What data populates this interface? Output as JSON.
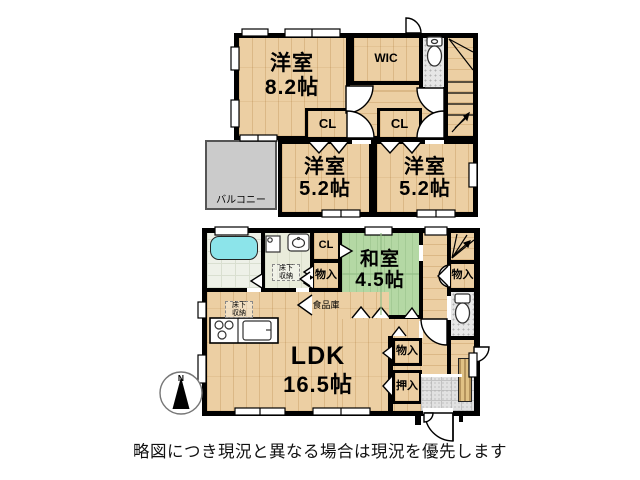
{
  "floor2": {
    "main_room": {
      "name": "洋室",
      "size": "8.2帖"
    },
    "wic_label": "WIC",
    "closet_left": "CL",
    "closet_right": "CL",
    "room_left": {
      "name": "洋室",
      "size": "5.2帖"
    },
    "room_right": {
      "name": "洋室",
      "size": "5.2帖"
    },
    "balcony_label": "バルコニー"
  },
  "floor1": {
    "tatami_room": {
      "name": "和室",
      "size": "4.5帖"
    },
    "ldk": {
      "name": "LDK",
      "size": "16.5帖"
    },
    "closet_label": "CL",
    "storage_label_1": "物入",
    "pantry_label": "食品庫",
    "underfloor_storage_washroom": {
      "line1": "床下",
      "line2": "収納"
    },
    "underfloor_storage_kitchen": {
      "line1": "床下",
      "line2": "収納"
    },
    "storage_label_2": "物入",
    "storage_label_3": "物入",
    "oshiire_label": "押入"
  },
  "compass": {
    "north": "N"
  },
  "disclaimer": "略図につき現況と異なる場合は現況を優先します",
  "colors": {
    "wall": "#000000",
    "wood_floor": "#eccfa3",
    "tatami": "#b4d8a4",
    "balcony": "#cbcbcb",
    "bathtub": "#8ce4ea",
    "background": "#ffffff"
  }
}
